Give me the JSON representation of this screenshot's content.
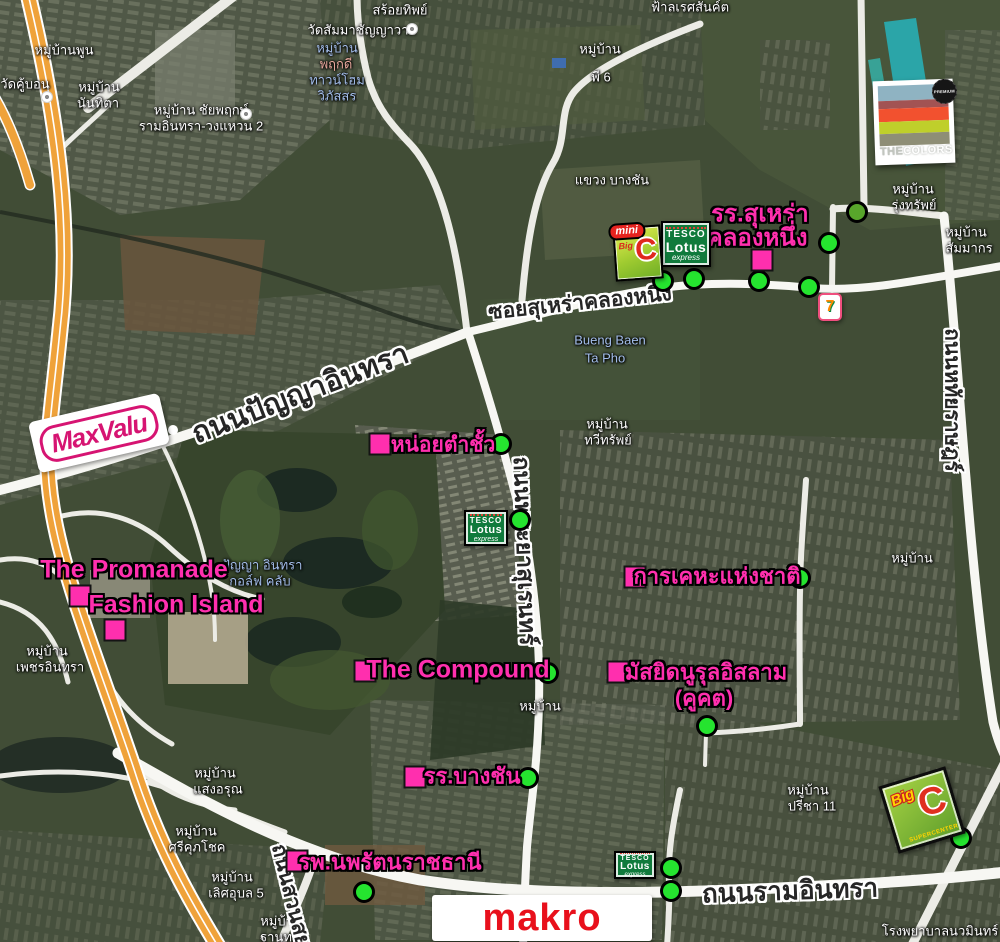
{
  "colors": {
    "pink": "#ff2fae",
    "marker_green": "#25e42f",
    "motorway_orange": "#efa23a",
    "tesco_green": "#107a3c",
    "bigc_green": "#7ab829",
    "makro_red": "#e8101c"
  },
  "pink_labels": {
    "surao_school": {
      "line1": "รร.สุเหร่า",
      "line2": "คลองหนึ่ง"
    },
    "noi_tam_chua": "หน่อยตำชั้ว",
    "promanade": "The Promanade",
    "fashion_island": "Fashion Island",
    "national_housing": "การเคหะแห่งชาติ",
    "compound": "The Compound",
    "mosque": {
      "line1": "มัสยิดนูรุลอิสลาม",
      "line2": "(คูคต)"
    },
    "bangchan_school": "รร.บางชัน",
    "hospital": "รพ.นพรัตนราชธานี"
  },
  "road_labels": {
    "panya_indra": "ถนนปัญญาอินทรา",
    "soi_surao": "ซอยสุเหร่าคลองหนึ่ง",
    "phraya_suren": "ถนนพระยาสุเรนทร์",
    "hathairat": "ถนนหทัยราษฎร์",
    "ram_indra": "ถนนรามอินทรา",
    "suan_siam": "ถนนสวนสยาม"
  },
  "logos": {
    "maxvalu": "MaxValu",
    "makro": "makro",
    "tesco": {
      "line1": "TESCO",
      "line2": "Lotus",
      "line3": "express"
    },
    "mini_bigc": {
      "mini": "mini",
      "big": "Big",
      "c": "C"
    },
    "bigc": {
      "big": "Big",
      "c": "C",
      "super": "SUPERCENTER"
    },
    "seven_eleven": {
      "seven": "7"
    },
    "the_colors": {
      "the": "THE",
      "colors": "COLORS",
      "premium": "PREMIUM"
    }
  },
  "bg_labels": [
    "สร้อยทิพย์",
    "วัดสัมมาชัญญาวาส",
    "วัดคู้บอน",
    "หมู่บ้านพูน",
    "หมู่บ้าน",
    "นันทิตา",
    "หมู่บ้าน ชัยพฤกษ์",
    "รามอินทรา-วงแหวน 2",
    "หมู่บ้าน",
    "พฤกดี",
    "ทาวน์โฮม",
    "วิภัสสร",
    "หมู่บ้าน",
    "พี 6",
    "แขวง บางชัน",
    "หมู่บ้าน",
    "รุ่งทรัพย์",
    "หมู่บ้าน",
    "สัมมากร",
    "Bueng Baen",
    "Ta Pho",
    "หมู่บ้าน",
    "ทวีทรัพย์",
    "ปัญญา อินทรา",
    "กอล์ฟ คลับ",
    "หมู่บ้าน",
    "เพชรอินทรา",
    "หมู่บ้าน",
    "แสงอรุณ",
    "หมู่บ้าน",
    "ศรีคุภโชค",
    "หมู่บ้าน",
    "เลิศอุบล 5",
    "หมู่บ้าน",
    "ฐานทอง",
    "หมู่บ้าน",
    "ปรีชา 11",
    "โรงพยาบาลนวมินทร์",
    "หมู่บ้าน",
    "หมู่บ้าน",
    "ฟ้าลเรศสันค์ต"
  ]
}
